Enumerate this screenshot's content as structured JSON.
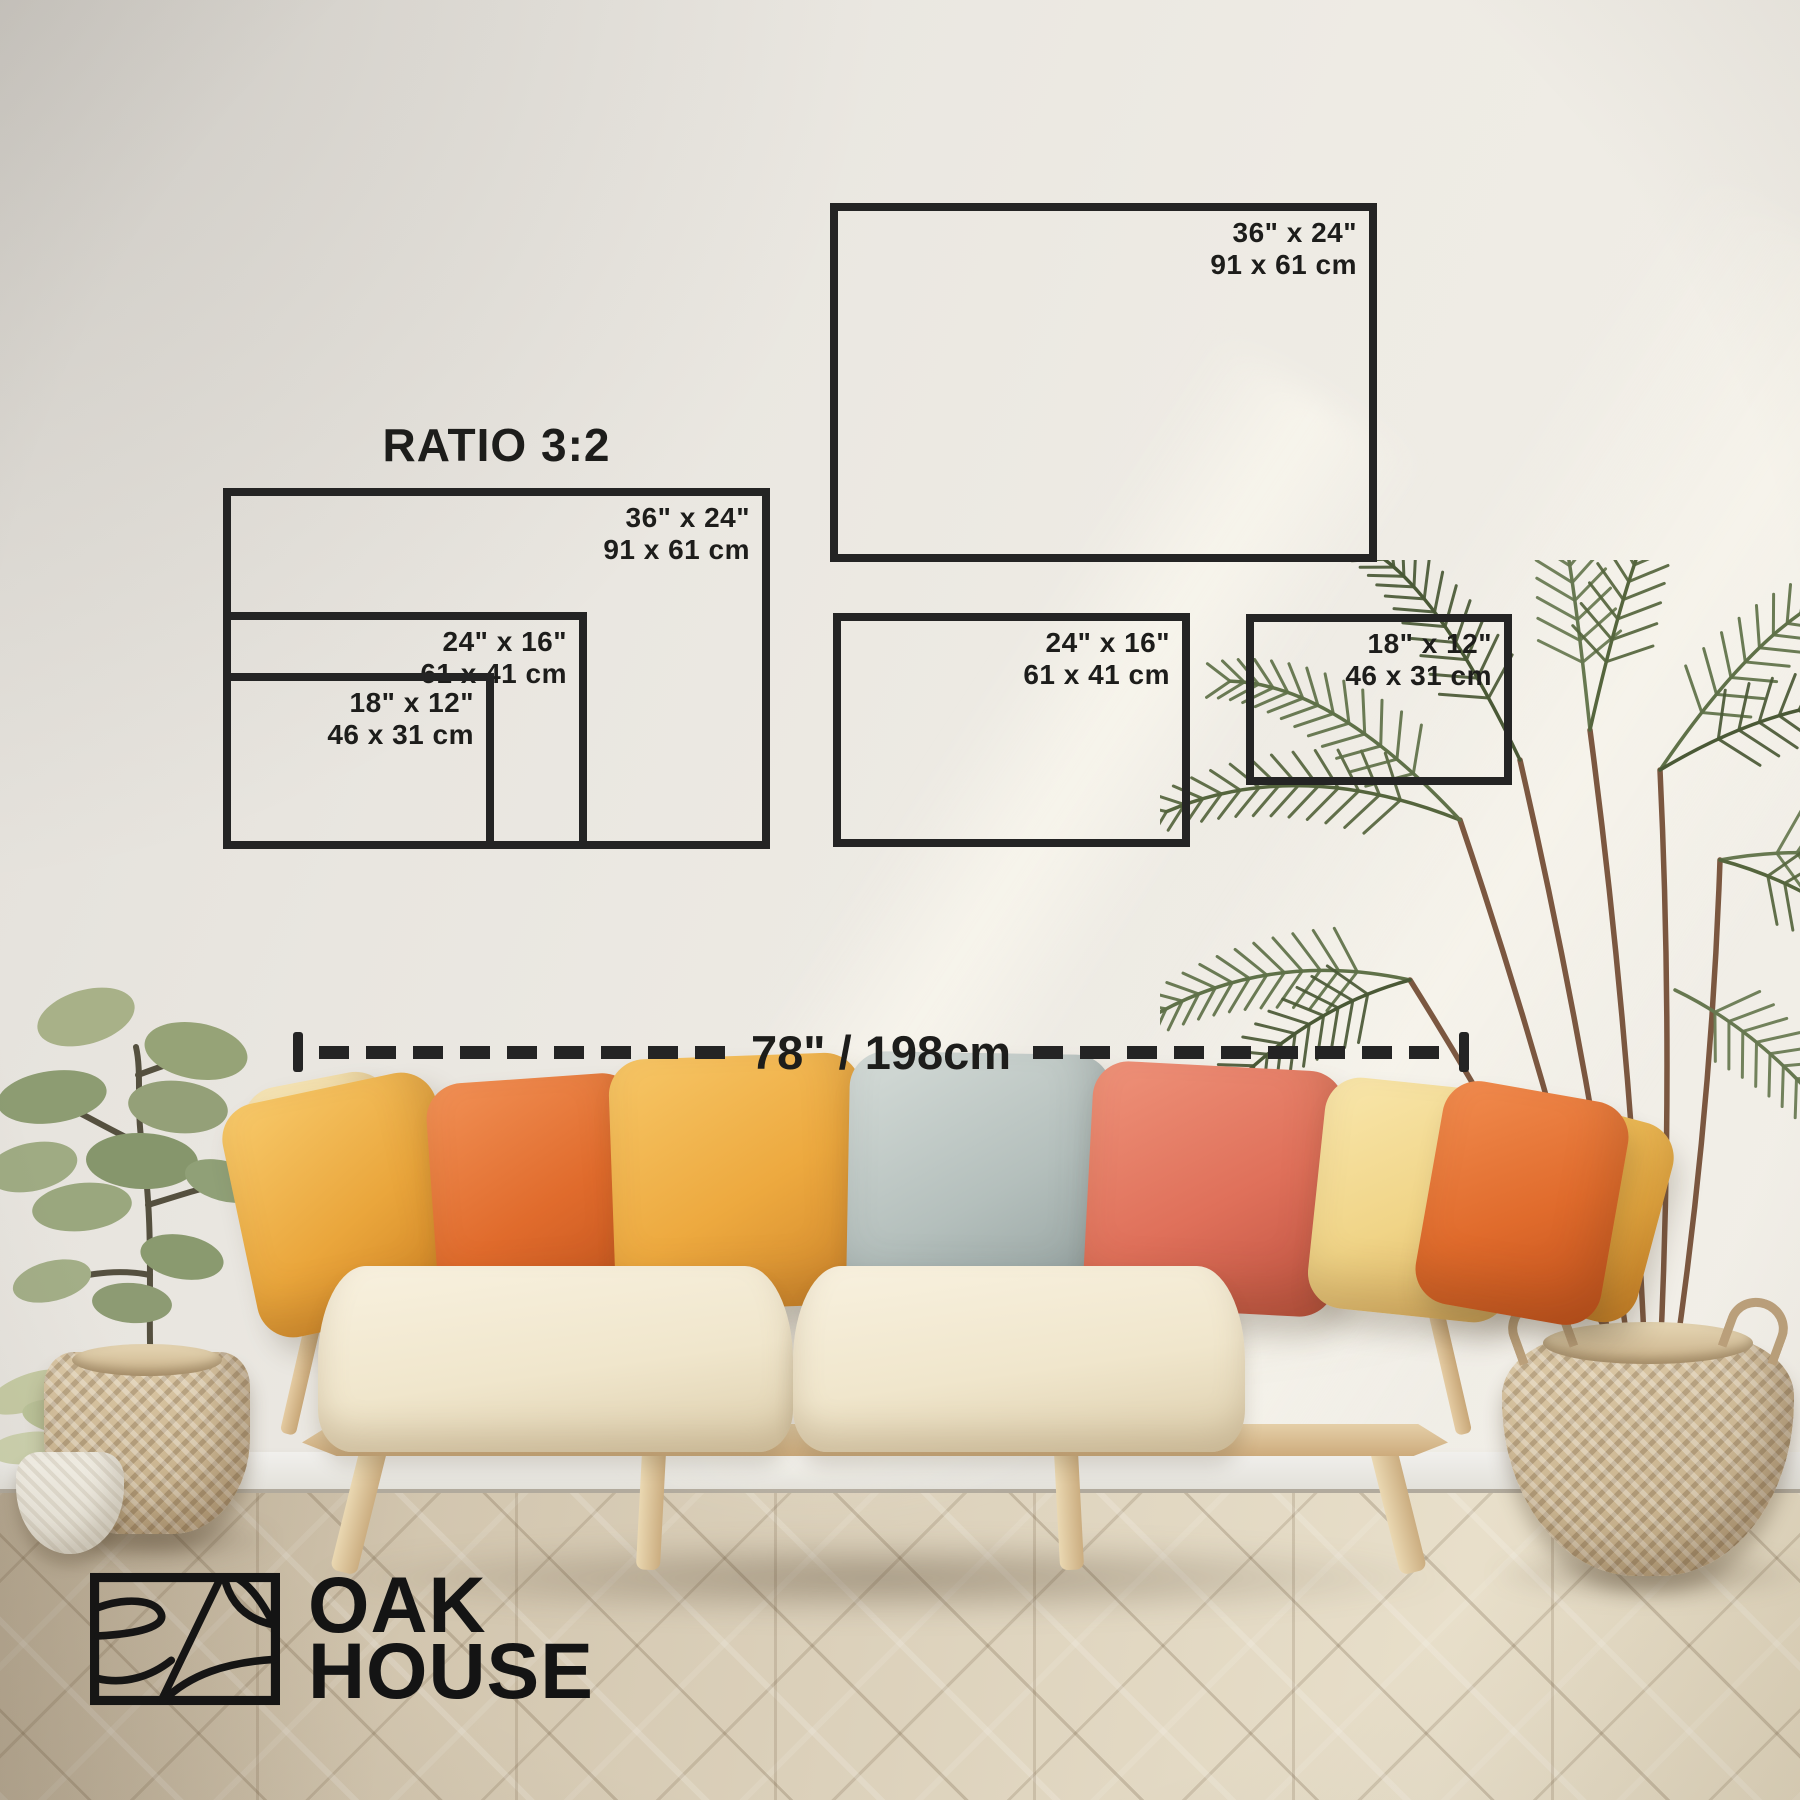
{
  "brand": {
    "line1": "OAK",
    "line2": "HOUSE"
  },
  "size_guide": {
    "ratio_label": "RATIO 3:2",
    "frames": [
      {
        "name": "ratio-group-36x24",
        "inches": "36\" x 24\"",
        "cm": "91 x 61 cm"
      },
      {
        "name": "ratio-group-24x16",
        "inches": "24\" x 16\"",
        "cm": "61 x 41 cm"
      },
      {
        "name": "ratio-group-18x12",
        "inches": "18\" x 12\"",
        "cm": "46 x 31 cm"
      },
      {
        "name": "wall-36x24",
        "inches": "36\" x 24\"",
        "cm": "91 x 61 cm"
      },
      {
        "name": "wall-24x16",
        "inches": "24\" x 16\"",
        "cm": "61 x 41 cm"
      },
      {
        "name": "wall-18x12",
        "inches": "18\" x 12\"",
        "cm": "46 x 31 cm"
      }
    ],
    "wall_width_label": "78\" / 198cm"
  },
  "colors": {
    "outline": "#242424",
    "label_text": "#1d1d1b",
    "wall": "#eae7e1",
    "floor_wood": "#d8ccb7",
    "sofa_fabric": "#f2e9d3",
    "wood_frame": "#d9bd95",
    "pillow_golden": "#eda93f",
    "pillow_orange": "#e46f2e",
    "pillow_gray_blue": "#b7c0bd",
    "pillow_coral": "#e0755f",
    "pillow_pale_yellow": "#f2d88c",
    "plant_sage": "#94a078",
    "palm_green": "#55653d",
    "basket_weave": "#cdb795"
  }
}
